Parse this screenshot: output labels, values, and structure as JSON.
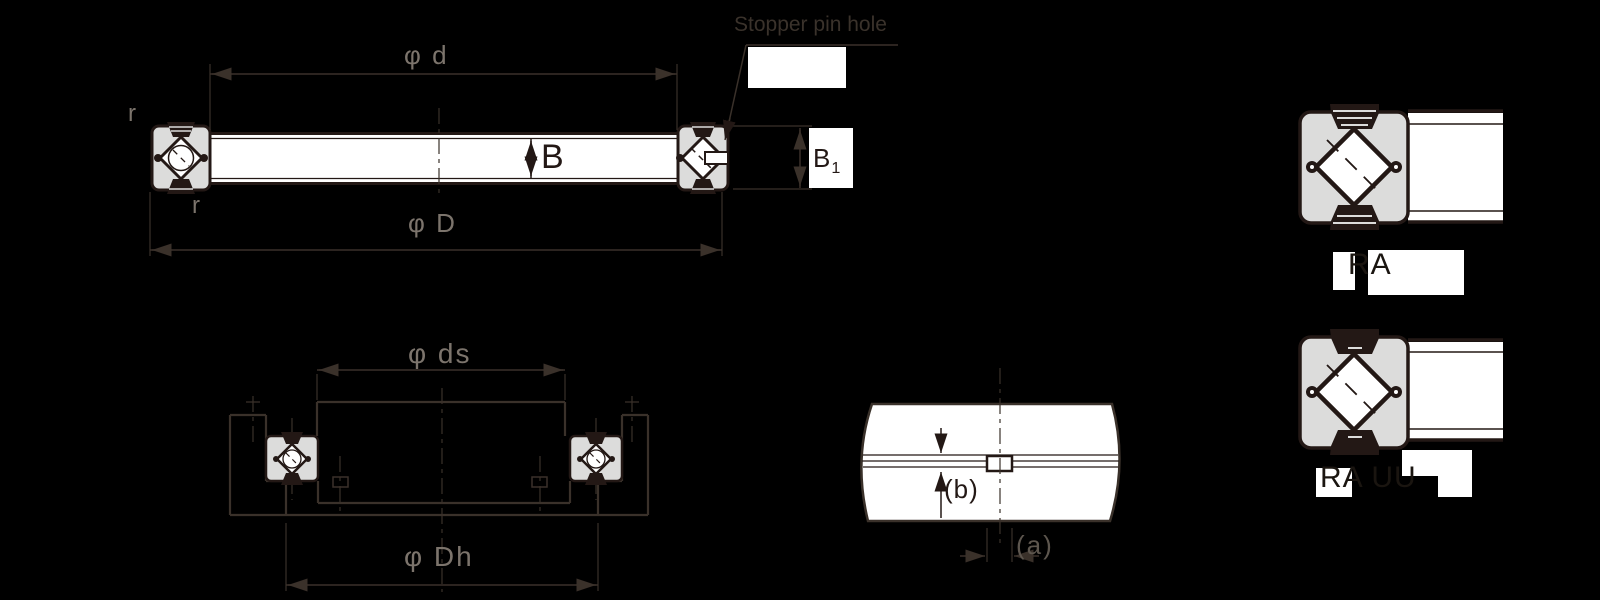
{
  "figure_title": "Crossed roller bearing dimension drawing",
  "palette": {
    "background": "#000000",
    "line": "#3a312a",
    "ink": "#231815",
    "label_gray": "#7c746c",
    "fill_white": "#ffffff",
    "fill_gray": "#dcdcdb"
  },
  "main_view": {
    "phi_d": "φ d",
    "phi_D": "φ D",
    "width_label": "B",
    "width1_label": "B",
    "width1_sub": "1",
    "fillet_top_left": "r",
    "fillet_bottom": "r",
    "stopper_callout": "Stopper pin hole"
  },
  "mounting_view": {
    "phi_ds": "φ ds",
    "phi_Dh": "φ Dh"
  },
  "detail_view": {
    "dim_b": "(b)",
    "dim_a": "(a)"
  },
  "type_figures": [
    {
      "caption": "RA"
    },
    {
      "caption": "RA UU"
    }
  ]
}
